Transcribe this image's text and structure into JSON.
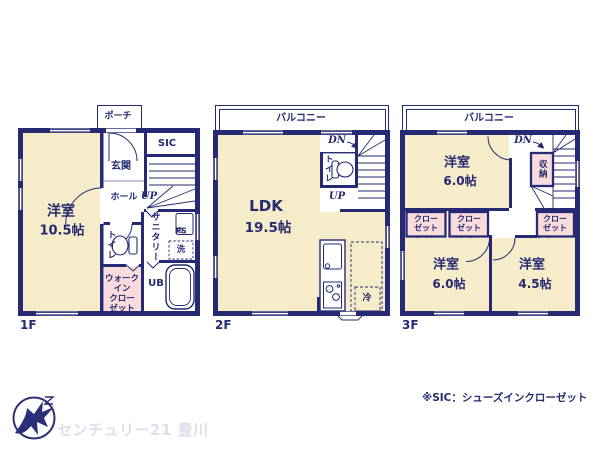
{
  "colors": {
    "wall_navy": "#252a72",
    "room_cream": "#f7ecca",
    "closet_pink": "#fbdcdd",
    "brand_text_gray": "#dde0ec"
  },
  "floor1": {
    "label": "1F",
    "porch": "ポーチ",
    "sic": "SIC",
    "genkan": "玄関",
    "hall": "ホール",
    "up": "UP",
    "room_name": "洋室",
    "room_size": "10.5帖",
    "sanitary": "サニタリー",
    "ps": "PS",
    "laundry": "洗",
    "toilet": "トイレ",
    "wic": "ウォーク\nイン\nクロー\nゼット",
    "ub": "UB"
  },
  "floor2": {
    "label": "2F",
    "balcony": "バルコニー",
    "dn": "DN",
    "toilet": "トイレ",
    "up": "UP",
    "ldk_name": "LDK",
    "ldk_size": "19.5帖",
    "fridge": "冷"
  },
  "floor3": {
    "label": "3F",
    "balcony": "バルコニー",
    "dn": "DN",
    "storage": "収納",
    "room_top_name": "洋室",
    "room_top_size": "6.0帖",
    "closet_a": "クロー\nゼット",
    "closet_b": "クロー\nゼット",
    "closet_c": "クロー\nゼット",
    "room_bl_name": "洋室",
    "room_bl_size": "6.0帖",
    "room_br_name": "洋室",
    "room_br_size": "4.5帖"
  },
  "footer": {
    "brand": "センチュリー21 豊川",
    "note": "※SIC：シューズインクローゼット"
  }
}
